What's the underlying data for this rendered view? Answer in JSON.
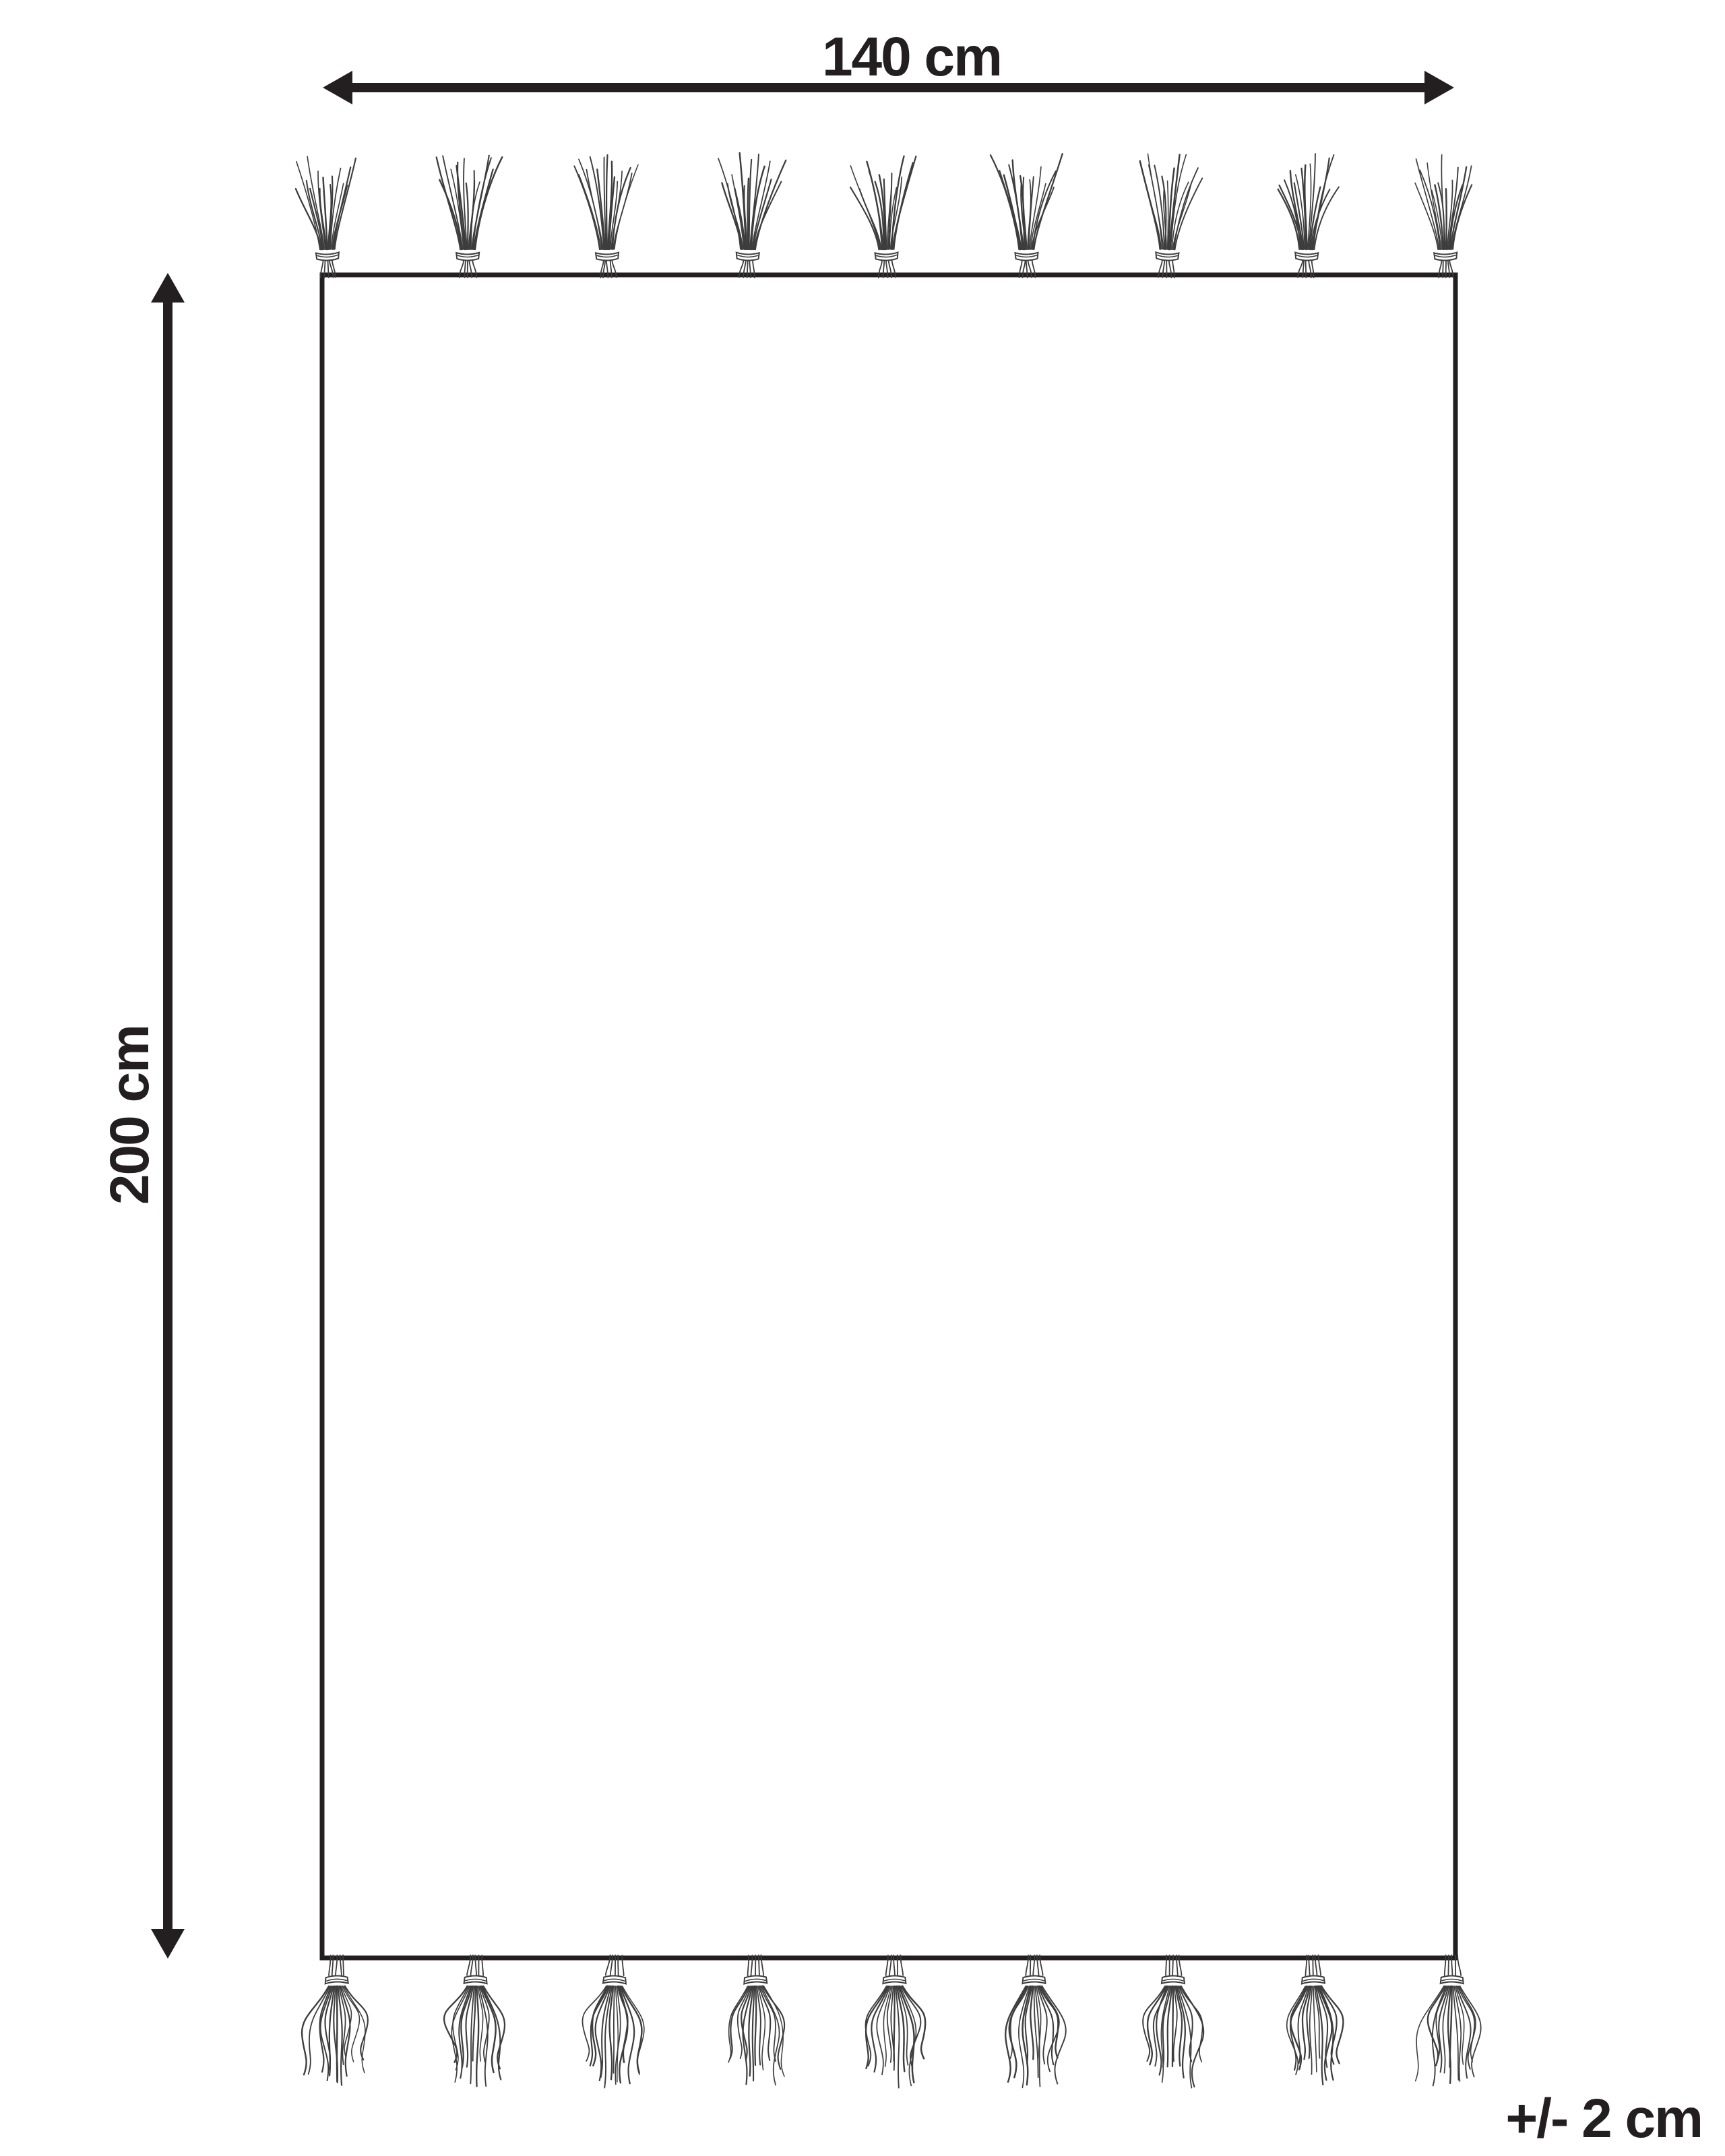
{
  "diagram": {
    "background_color": "#ffffff",
    "line_color": "#231f20",
    "strand_color": "#3d3d3d",
    "rug_fill": "#ffffff",
    "width_label": "140 cm",
    "height_label": "200 cm",
    "tolerance_label": "+/- 2 cm",
    "fringe": {
      "top_tassel_count": 9,
      "bottom_tassel_count": 9
    }
  }
}
